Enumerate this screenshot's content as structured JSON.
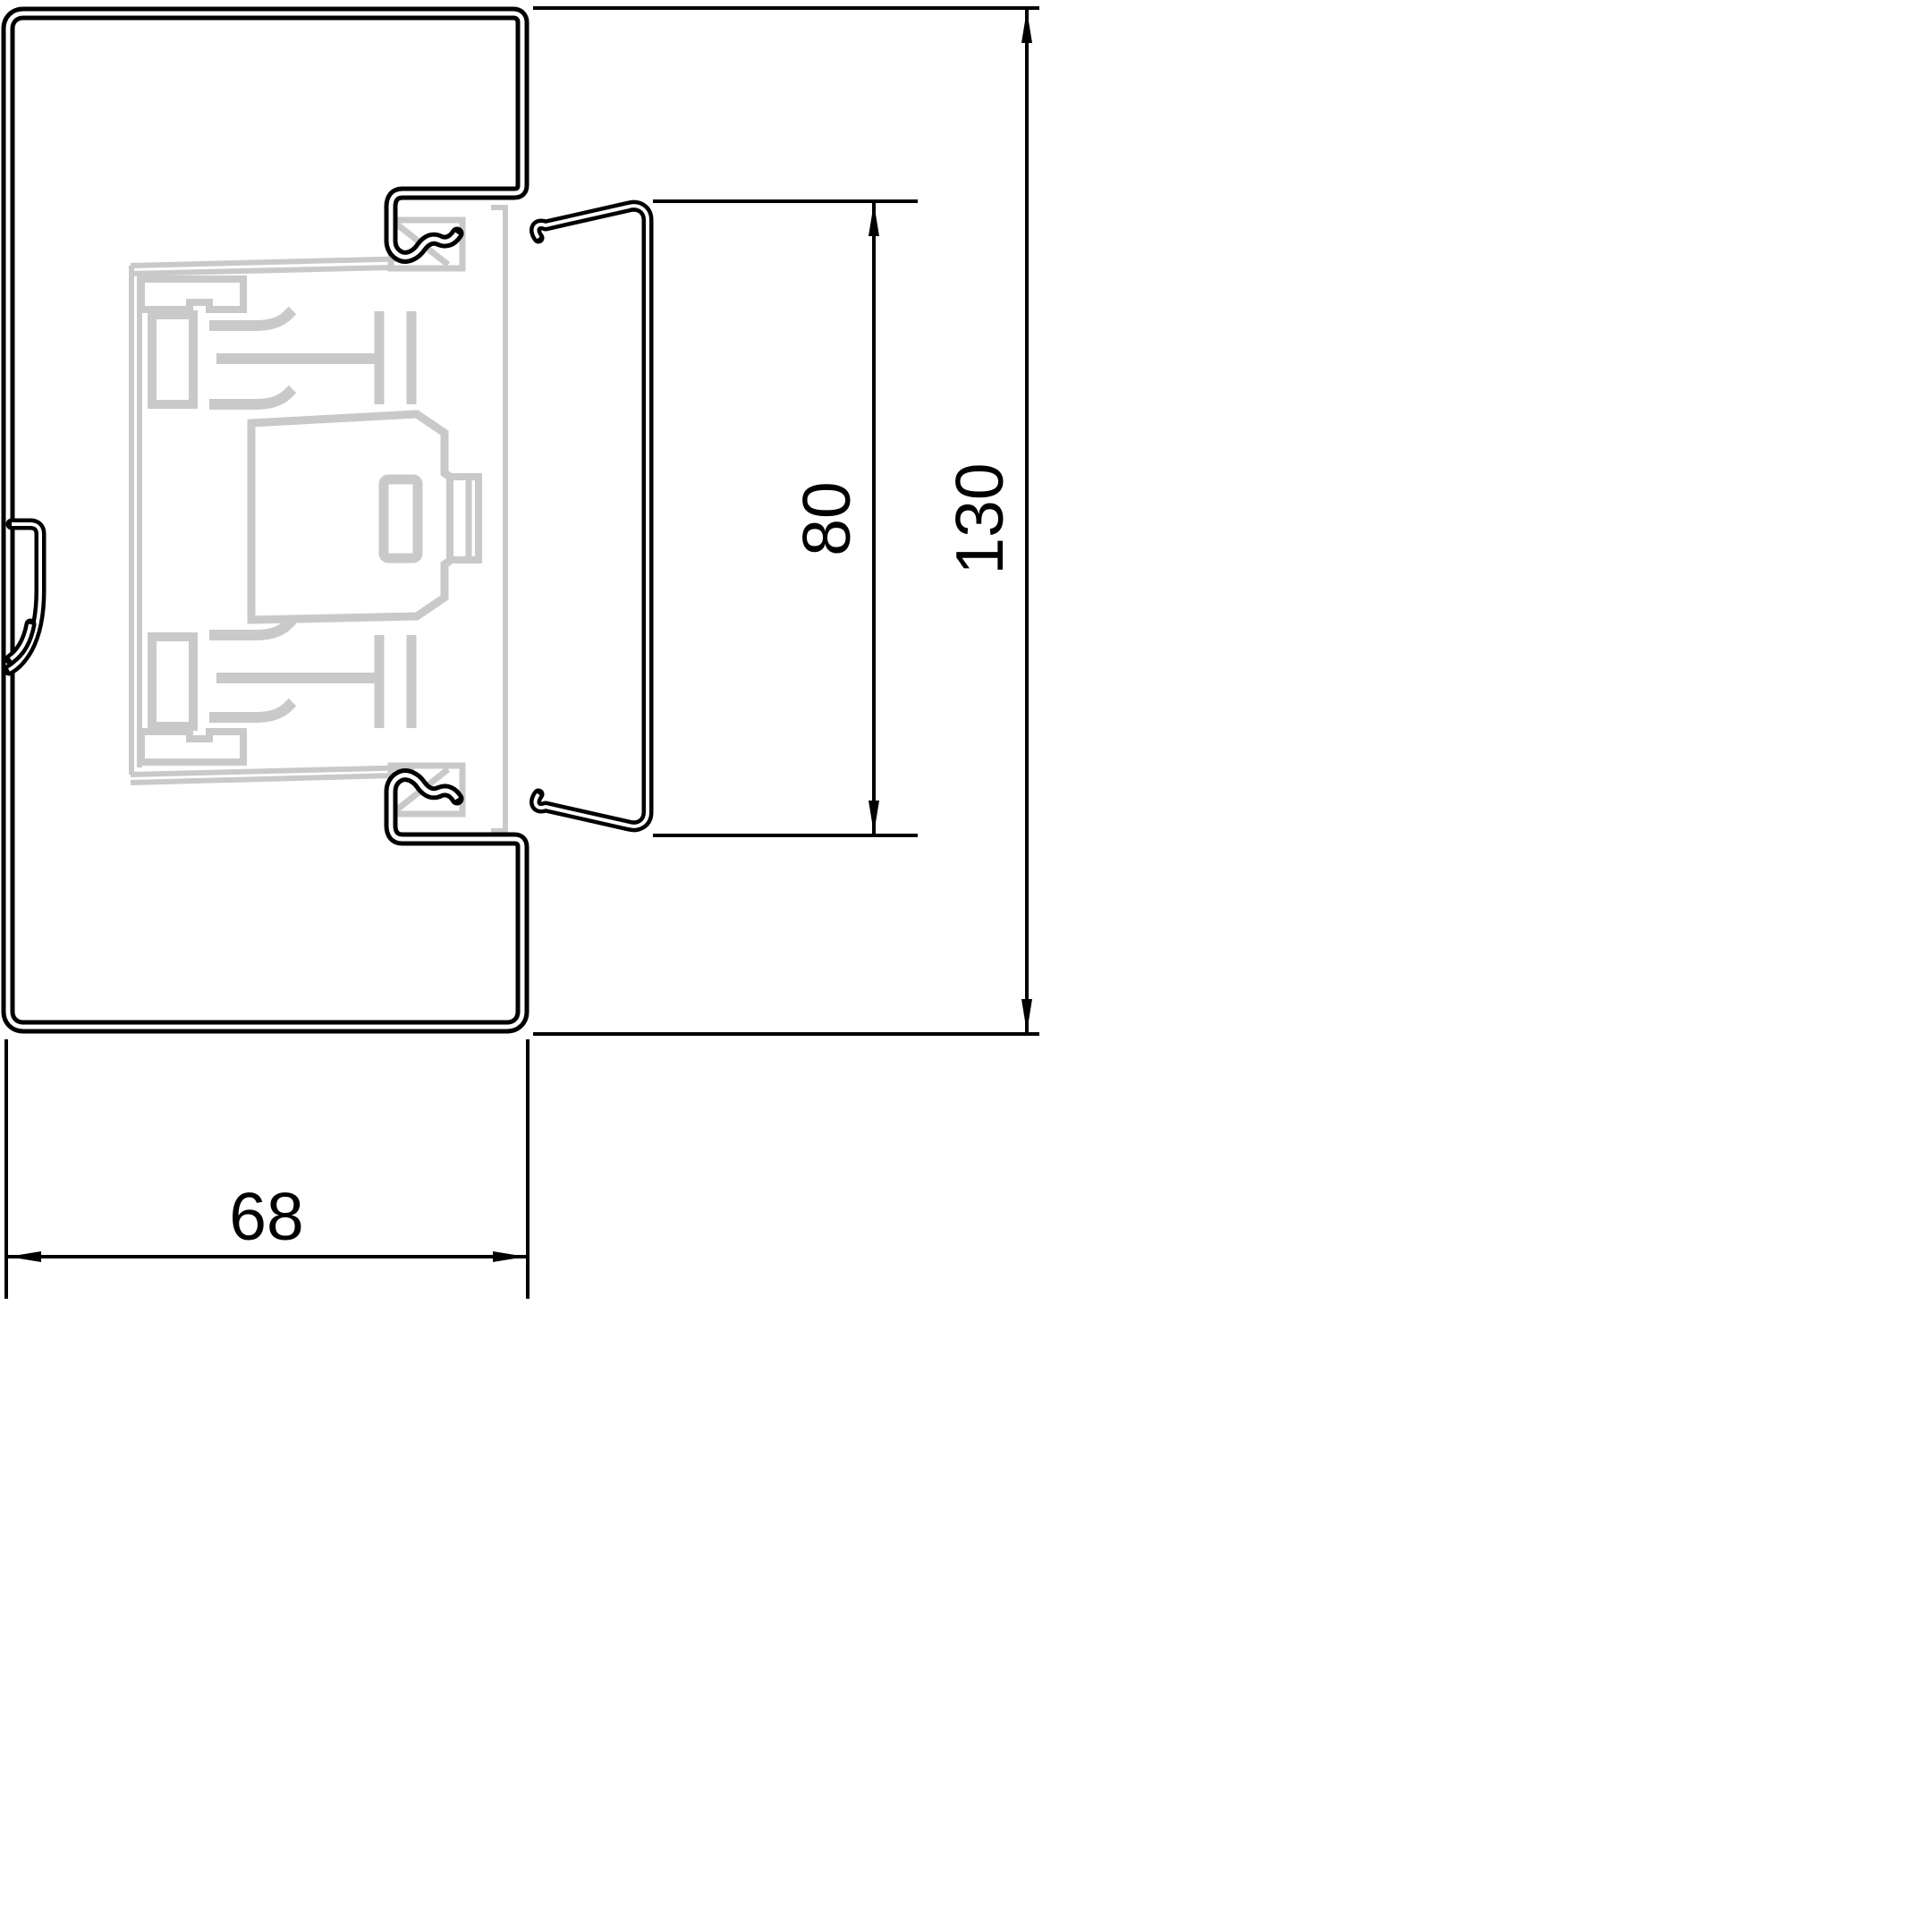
{
  "drawing": {
    "title": "trunking-profile-cross-section",
    "dimensions": {
      "width": "68",
      "opening_height": "80",
      "total_height": "130"
    },
    "colors": {
      "line": "#000000",
      "ghost_device": "#c9c9c9",
      "background": "#ffffff"
    }
  }
}
